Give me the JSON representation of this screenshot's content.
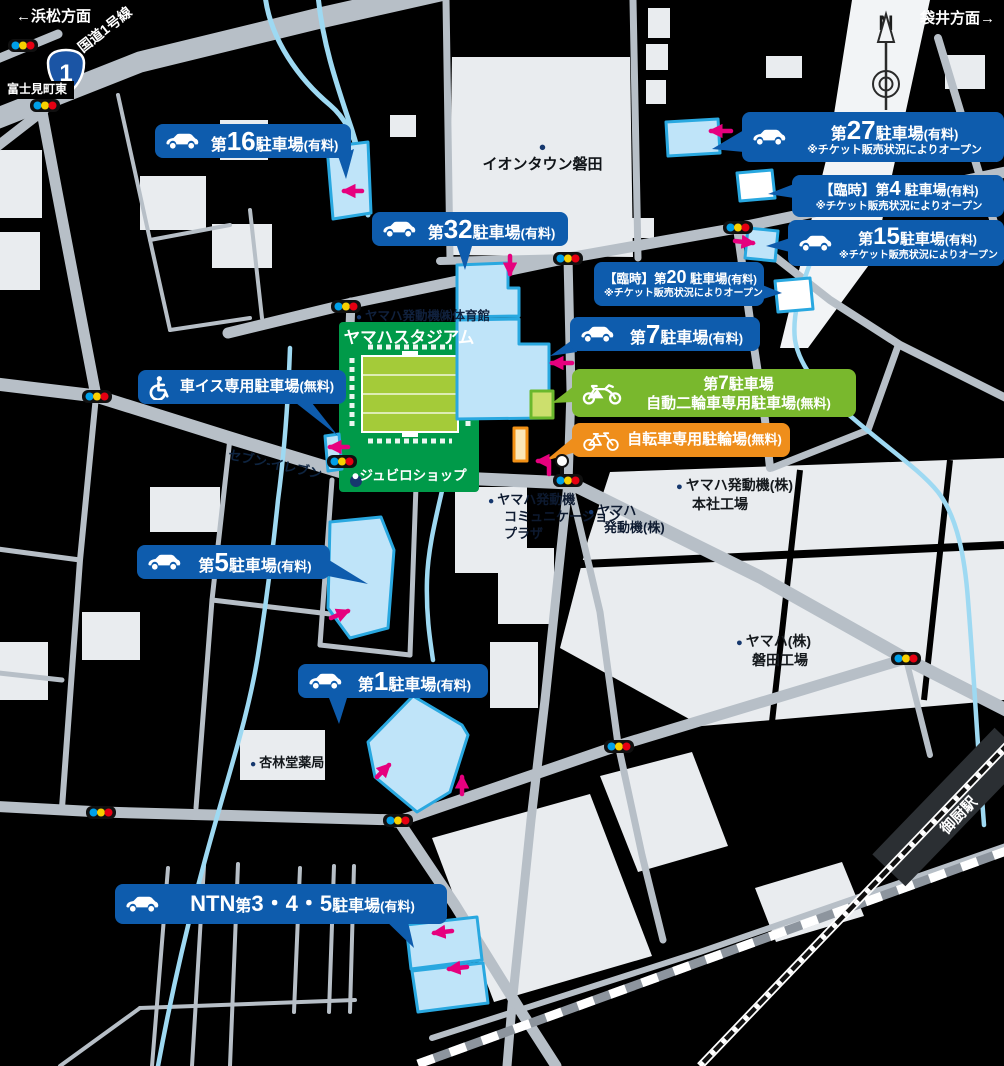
{
  "signs": {
    "route_shield_number": "1",
    "north_indicator": "N",
    "station_name": "御厨駅"
  },
  "colors": {
    "parking_label_blue": "#0e5cad",
    "motorcycle_label_green": "#79b82d",
    "bicycle_label_orange": "#ef8e1b",
    "parking_area_fill": "#bfe4f9",
    "parking_area_border": "#29a8e0",
    "arrow_pink": "#e6007e",
    "stadium_green": "#009a49",
    "pitch_green": "#a4cb39",
    "road_gray": "#b7bfc7",
    "water_blue": "#9ed9f2"
  },
  "map_labels": [
    {
      "id": "hamamatsu-direction",
      "x": 16,
      "y": 7,
      "size": 15,
      "color": "#ffffff",
      "bold": true,
      "lines": [
        "←浜松方面"
      ]
    },
    {
      "id": "fukuroi-direction",
      "x": 920,
      "y": 9,
      "size": 15,
      "color": "#ffffff",
      "bold": true,
      "lines": [
        "袋井方面→"
      ]
    },
    {
      "id": "route1-name",
      "x": 74,
      "y": 42,
      "size": 14,
      "color": "#ffffff",
      "bold": true,
      "rotate": -38,
      "lines": [
        "国道1号線"
      ]
    },
    {
      "id": "fujimicho-higashi",
      "x": 0,
      "y": 81,
      "size": 12,
      "color": "#ffffff",
      "bold": true,
      "box": true,
      "lines": [
        "富士見町東"
      ]
    },
    {
      "id": "aeon-town-iwata",
      "x": 450,
      "y": 141,
      "w": 185,
      "size": 15,
      "color": "#101418",
      "bold": true,
      "align": "center",
      "dot": "above",
      "dotColor": "#16386e",
      "lines": [
        "イオンタウン磐田"
      ]
    },
    {
      "id": "yamaha-gym",
      "x": 356,
      "y": 308,
      "size": 12.5,
      "color": "#10213d",
      "bold": true,
      "dot": "left",
      "dotColor": "#16386e",
      "lines": [
        "ヤマハ発動機㈱体育館"
      ]
    },
    {
      "id": "yamaha-stadium",
      "x": 341,
      "y": 328,
      "w": 136,
      "size": 16.5,
      "color": "#ffffff",
      "bold": true,
      "align": "center",
      "lines": [
        "ヤマハスタジアム"
      ]
    },
    {
      "id": "jubilo-shop",
      "x": 341,
      "y": 467,
      "w": 136,
      "size": 13.5,
      "color": "#ffffff",
      "bold": true,
      "align": "center",
      "lines": [
        "●ジュビロショップ"
      ]
    },
    {
      "id": "seven-eleven",
      "x": 230,
      "y": 447,
      "size": 13,
      "color": "#0e2440",
      "bold": true,
      "rotate": 12,
      "lines": [
        "セブン-イレブン"
      ]
    },
    {
      "id": "communication-plaza",
      "x": 488,
      "y": 492,
      "size": 13,
      "color": "#0d1a30",
      "bold": true,
      "dot": "left",
      "dotColor": "#16386e",
      "lines": [
        "ヤマハ発動機",
        "コミュニケーション",
        "プラザ"
      ]
    },
    {
      "id": "yamaha-hatsudoki",
      "x": 588,
      "y": 503,
      "size": 13,
      "color": "#0d1a30",
      "bold": true,
      "dot": "left",
      "dotColor": "#16386e",
      "lines": [
        "ヤマハ",
        "発動機(株)"
      ]
    },
    {
      "id": "honsha-factory",
      "x": 676,
      "y": 476,
      "size": 14,
      "color": "#14181c",
      "bold": true,
      "dot": "left",
      "dotColor": "#16386e",
      "lines": [
        "ヤマハ発動機(株)",
        "本社工場"
      ]
    },
    {
      "id": "iwata-factory",
      "x": 736,
      "y": 632,
      "size": 14,
      "color": "#14181c",
      "bold": true,
      "dot": "left",
      "dotColor": "#16386e",
      "lines": [
        "ヤマハ(株)",
        "磐田工場"
      ]
    },
    {
      "id": "kyorindo-pharmacy",
      "x": 250,
      "y": 755,
      "size": 13,
      "color": "#14181c",
      "bold": true,
      "dot": "left",
      "dotColor": "#16386e",
      "lines": [
        "杏林堂薬局"
      ]
    }
  ],
  "parkings": [
    {
      "id": "no16",
      "color": "blue",
      "icon": "car",
      "x": 155,
      "y": 124,
      "w": 196,
      "h": 34,
      "lines": [
        [
          [
            "第",
            16
          ],
          [
            "16",
            26
          ],
          [
            "駐車場",
            16
          ],
          [
            "(有料)",
            13
          ]
        ]
      ]
    },
    {
      "id": "no32",
      "color": "blue",
      "icon": "car",
      "x": 372,
      "y": 212,
      "w": 196,
      "h": 34,
      "lines": [
        [
          [
            "第",
            16
          ],
          [
            "32",
            26
          ],
          [
            "駐車場",
            16
          ],
          [
            "(有料)",
            13
          ]
        ]
      ]
    },
    {
      "id": "no27",
      "color": "blue",
      "icon": "car",
      "x": 742,
      "y": 112,
      "w": 262,
      "h": 50,
      "lines": [
        [
          [
            "第",
            16
          ],
          [
            "27",
            26
          ],
          [
            "駐車場",
            16
          ],
          [
            "(有料)",
            13
          ]
        ]
      ],
      "note": "※チケット販売状況によりオープン",
      "noteSize": 11
    },
    {
      "id": "no4-temp",
      "color": "blue",
      "x": 792,
      "y": 175,
      "w": 212,
      "h": 42,
      "lines": [
        [
          [
            "【臨時】第",
            14
          ],
          [
            "4",
            20
          ],
          [
            " 駐車場",
            14
          ],
          [
            "(有料)",
            12
          ]
        ]
      ],
      "note": "※チケット販売状況によりオープン",
      "noteSize": 10.5
    },
    {
      "id": "no15",
      "color": "blue",
      "icon": "car",
      "x": 788,
      "y": 220,
      "w": 216,
      "h": 46,
      "lines": [
        [
          [
            "第",
            15
          ],
          [
            "15",
            24
          ],
          [
            "駐車場",
            15
          ],
          [
            "(有料)",
            12
          ]
        ]
      ],
      "note": "※チケット販売状況によりオープン",
      "noteSize": 10
    },
    {
      "id": "no20-temp",
      "color": "blue",
      "x": 594,
      "y": 262,
      "w": 170,
      "h": 44,
      "lines": [
        [
          [
            "【臨時】第",
            12.5
          ],
          [
            "20",
            18
          ],
          [
            " 駐車場",
            12.5
          ],
          [
            "(有料)",
            11
          ]
        ]
      ],
      "note": "※チケット販売状況によりオープン",
      "noteSize": 10
    },
    {
      "id": "no7",
      "color": "blue",
      "icon": "car",
      "x": 570,
      "y": 317,
      "w": 190,
      "h": 34,
      "lines": [
        [
          [
            "第",
            16
          ],
          [
            "7",
            26
          ],
          [
            "駐車場",
            16
          ],
          [
            "(有料)",
            13
          ]
        ]
      ]
    },
    {
      "id": "wheelchair",
      "color": "blue",
      "icon": "wheelchair",
      "x": 138,
      "y": 370,
      "w": 208,
      "h": 34,
      "lines": [
        [
          [
            "車イス専用駐車場",
            15
          ],
          [
            "(無料)",
            13
          ]
        ]
      ]
    },
    {
      "id": "no7-motorcycle",
      "color": "green",
      "icon": "motorcycle",
      "x": 572,
      "y": 369,
      "w": 284,
      "h": 48,
      "lines": [
        [
          [
            "第",
            15
          ],
          [
            "7",
            19
          ],
          [
            "駐車場",
            15
          ]
        ],
        [
          [
            "自動二輪車専用駐車場",
            15
          ],
          [
            "(無料)",
            13
          ]
        ]
      ]
    },
    {
      "id": "bicycle",
      "color": "orange",
      "icon": "bicycle",
      "x": 572,
      "y": 423,
      "w": 218,
      "h": 34,
      "lines": [
        [
          [
            "自転車専用駐輪場",
            15
          ],
          [
            "(無料)",
            13
          ]
        ]
      ]
    },
    {
      "id": "no5",
      "color": "blue",
      "icon": "car",
      "x": 137,
      "y": 545,
      "w": 193,
      "h": 34,
      "lines": [
        [
          [
            "第",
            16
          ],
          [
            "5",
            26
          ],
          [
            "駐車場",
            16
          ],
          [
            "(有料)",
            13
          ]
        ]
      ]
    },
    {
      "id": "no1",
      "color": "blue",
      "icon": "car",
      "x": 298,
      "y": 664,
      "w": 190,
      "h": 34,
      "lines": [
        [
          [
            "第",
            16
          ],
          [
            "1",
            26
          ],
          [
            "駐車場",
            16
          ],
          [
            "(有料)",
            13
          ]
        ]
      ]
    },
    {
      "id": "ntn345",
      "color": "blue",
      "icon": "car",
      "x": 115,
      "y": 884,
      "w": 332,
      "h": 40,
      "lines": [
        [
          [
            "NTN",
            22
          ],
          [
            "第",
            16
          ],
          [
            "3・4・5",
            22
          ],
          [
            "駐車場",
            16
          ],
          [
            "(有料)",
            13
          ]
        ]
      ]
    }
  ]
}
